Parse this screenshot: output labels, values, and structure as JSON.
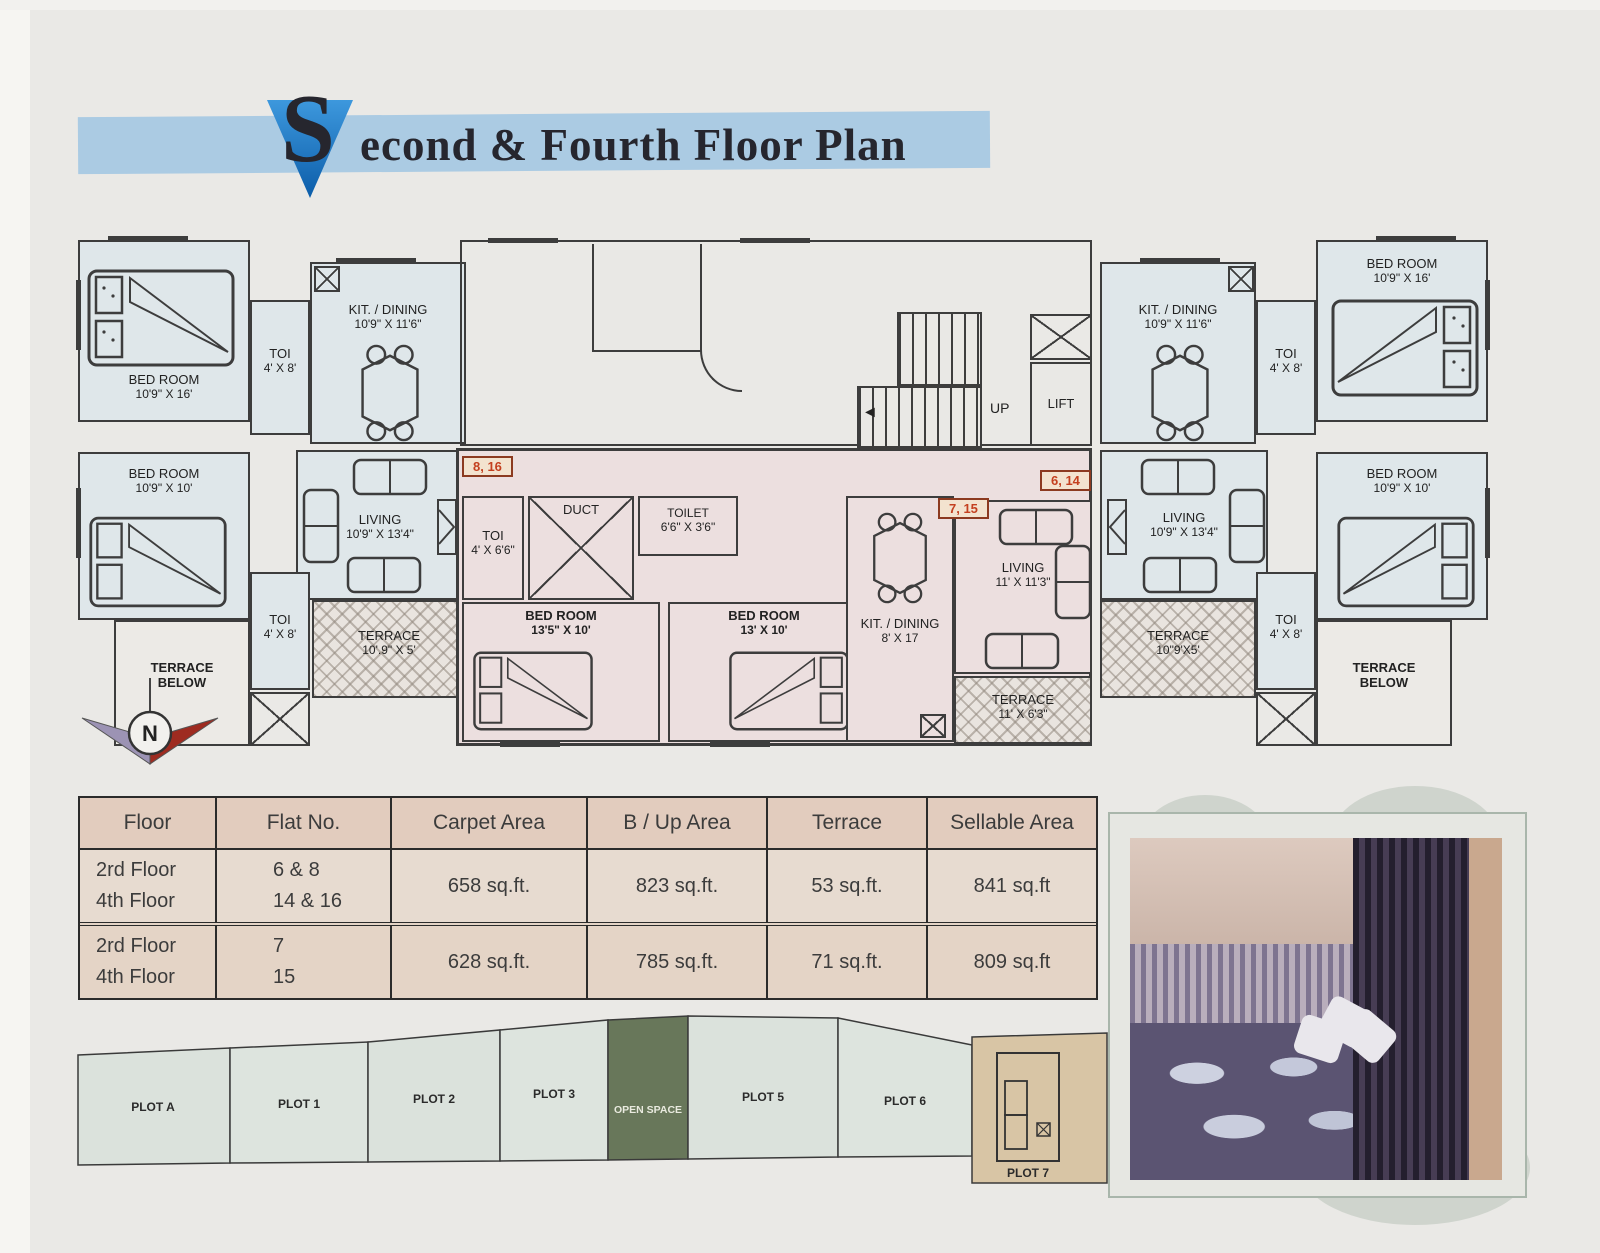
{
  "title": {
    "initial": "S",
    "rest": "econd & Fourth Floor Plan"
  },
  "plan": {
    "rooms": [
      {
        "label": "BED ROOM",
        "dims": "10'9\" X 16'"
      },
      {
        "label": "TOI",
        "dims": "4' X 8'"
      },
      {
        "label": "KIT. / DINING",
        "dims": "10'9\" X 11'6\""
      },
      {
        "label": "BED ROOM",
        "dims": "10'9\" X 10'"
      },
      {
        "label": "LIVING",
        "dims": "10'9\" X 13'4\""
      },
      {
        "label": "TOI",
        "dims": "4' X 8'"
      },
      {
        "label": "TERRACE",
        "dims": "BELOW"
      },
      {
        "label": "TERRACE",
        "dims": "10'.9\" X 5'"
      },
      {
        "label": "TOI",
        "dims": "4' X 6'6\""
      },
      {
        "label": "DUCT",
        "dims": ""
      },
      {
        "label": "TOILET",
        "dims": "6'6\" X 3'6\""
      },
      {
        "label": "BED ROOM",
        "dims": "13'5\" X 10'"
      },
      {
        "label": "BED ROOM",
        "dims": "13' X 10'"
      },
      {
        "label": "KIT. / DINING",
        "dims": "8' X 17"
      },
      {
        "label": "LIVING",
        "dims": "11' X 11'3\""
      },
      {
        "label": "TERRACE",
        "dims": "11' X 6'3\""
      },
      {
        "label": "UP",
        "dims": ""
      },
      {
        "label": "LIFT",
        "dims": ""
      },
      {
        "label": "KIT. / DINING",
        "dims": "10'9\" X 11'6\""
      },
      {
        "label": "TOI",
        "dims": "4' X 8'"
      },
      {
        "label": "BED ROOM",
        "dims": "10'9\" X 16'"
      },
      {
        "label": "LIVING",
        "dims": "10'9\" X 13'4\""
      },
      {
        "label": "BED ROOM",
        "dims": "10'9\" X 10'"
      },
      {
        "label": "TOI",
        "dims": "4' X 8'"
      },
      {
        "label": "TERRACE",
        "dims": "10\"9'X5'"
      },
      {
        "label": "TERRACE",
        "dims": "BELOW"
      }
    ],
    "flags": [
      "8, 16",
      "7, 15",
      "6, 14"
    ],
    "compass": {
      "label": "N"
    }
  },
  "table": {
    "headers": [
      "Floor",
      "Flat No.",
      "Carpet Area",
      "B / Up Area",
      "Terrace",
      "Sellable Area"
    ],
    "rows": [
      {
        "floor1": "2rd Floor",
        "floor2": "4th Floor",
        "flat1": "6 & 8",
        "flat2": "14 & 16",
        "carpet": "658 sq.ft.",
        "bup": "823 sq.ft.",
        "terrace": "53 sq.ft.",
        "sellable": "841 sq.ft"
      },
      {
        "floor1": "2rd Floor",
        "floor2": "4th Floor",
        "flat1": "7",
        "flat2": "15",
        "carpet": "628 sq.ft.",
        "bup": "785 sq.ft.",
        "terrace": "71 sq.ft.",
        "sellable": "809 sq.ft"
      }
    ]
  },
  "plots": {
    "items": [
      "PLOT A",
      "PLOT 1",
      "PLOT 2",
      "PLOT 3",
      "OPEN SPACE",
      "PLOT 5",
      "PLOT 6",
      "PLOT 7"
    ]
  }
}
